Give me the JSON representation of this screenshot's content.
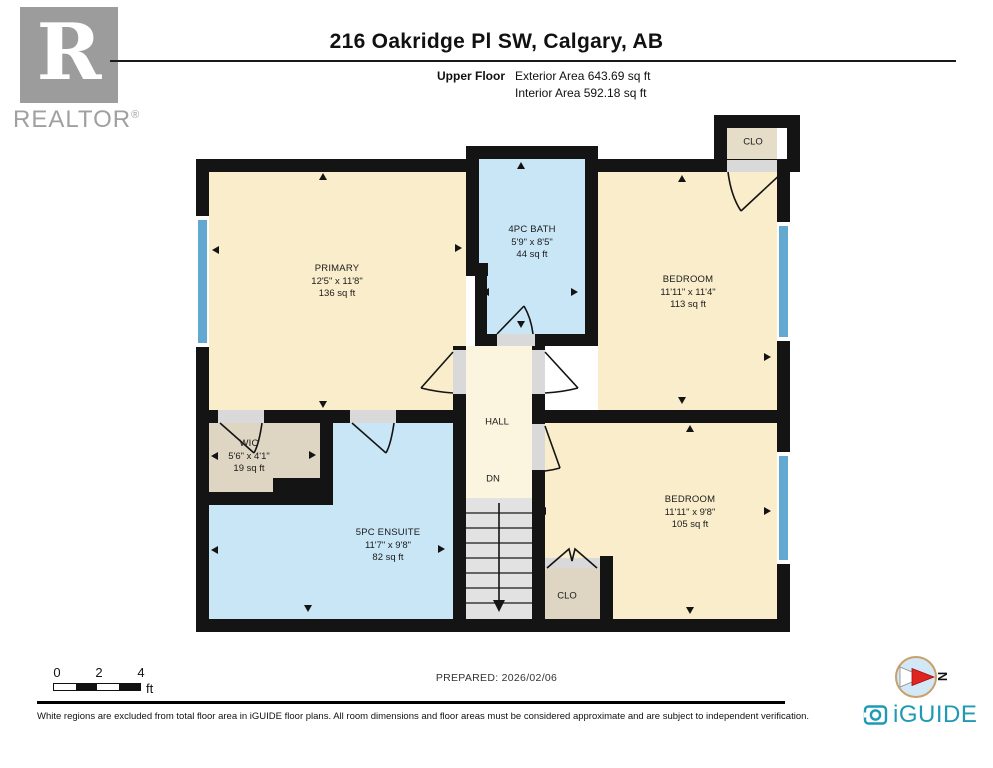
{
  "header": {
    "title": "216 Oakridge Pl SW, Calgary, AB",
    "floor_label": "Upper Floor",
    "exterior_area": "Exterior Area 643.69 sq ft",
    "interior_area": "Interior Area 592.18 sq ft"
  },
  "branding": {
    "realtor_r": "R",
    "realtor_word": "REALTOR",
    "registered_mark": "®",
    "iguide_logo_text": "iGUIDE"
  },
  "rooms": {
    "primary": {
      "name": "PRIMARY",
      "dims": "12'5\" x 11'8\"",
      "area": "136 sq ft"
    },
    "bath": {
      "name": "4PC BATH",
      "dims": "5'9\" x 8'5\"",
      "area": "44 sq ft"
    },
    "bedroom_top": {
      "name": "BEDROOM",
      "dims": "11'11\" x 11'4\"",
      "area": "113 sq ft"
    },
    "wic": {
      "name": "WIC",
      "dims": "5'6\" x 4'1\"",
      "area": "19 sq ft"
    },
    "ensuite": {
      "name": "5PC ENSUITE",
      "dims": "11'7\" x 9'8\"",
      "area": "82 sq ft"
    },
    "bedroom_bottom": {
      "name": "BEDROOM",
      "dims": "11'11\" x 9'8\"",
      "area": "105 sq ft"
    },
    "hall": {
      "name": "HALL",
      "down_label": "DN"
    },
    "closet_top": {
      "name": "CLO"
    },
    "closet_bottom": {
      "name": "CLO"
    }
  },
  "scale_bar": {
    "tick_0": "0",
    "tick_2": "2",
    "tick_4": "4",
    "unit": "ft"
  },
  "footer": {
    "prepared": "PREPARED: 2026/02/06",
    "disclaimer": "White regions are excluded from total floor area in iGUIDE floor plans. All room dimensions and floor areas must be considered approximate and are subject to independent verification.",
    "compass_label": "N"
  },
  "colors": {
    "wall": "#141414",
    "room_cream": "#f9edcb",
    "room_blue": "#c8e6f5",
    "room_tan": "#ded5c2",
    "hall_cream": "#fbf5df",
    "stairs_gray": "#e2e2e2",
    "window_blue": "#62a8d1",
    "door_jamb_gray": "#d9d9d9",
    "iguide_teal": "#1e9ab4",
    "compass_red": "#e02420",
    "logo_gray": "#9c9c9c"
  }
}
